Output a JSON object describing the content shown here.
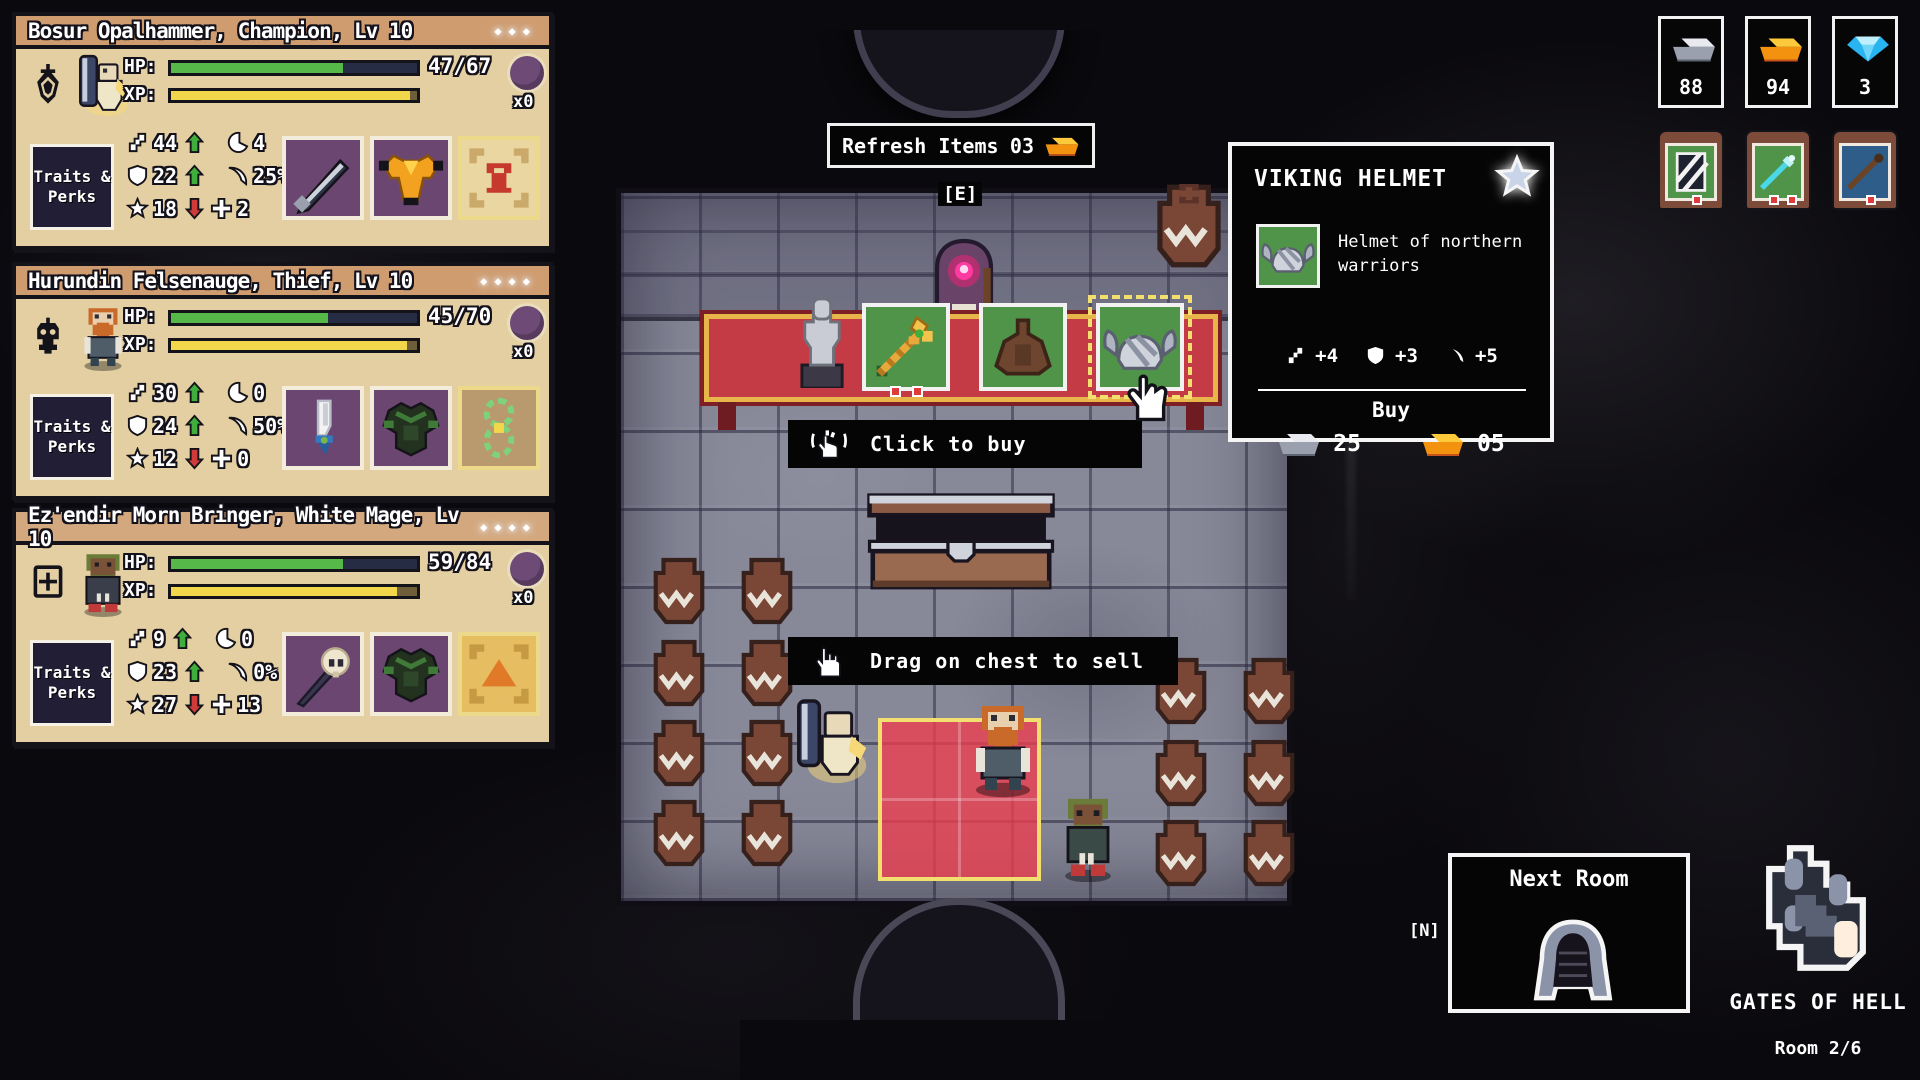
{
  "labels": {
    "hp": "HP:",
    "xp": "XP:",
    "traits_line1": "Traits &",
    "traits_line2": "Perks",
    "refresh": "Refresh Items",
    "refresh_cost": "03",
    "interact_key": "[E]",
    "next_key": "[N]",
    "click_to_buy": "Click to buy",
    "drag_to_sell": "Drag on chest to sell",
    "next_room": "Next Room",
    "location": "GATES OF HELL",
    "room_count": "Room 2/6",
    "sparkles3": "◆◆◆",
    "sparkles4": "◆◆◆◆"
  },
  "resources": {
    "iron": "88",
    "gold": "94",
    "diamond": "3"
  },
  "party": [
    {
      "name": "Bosur Opalhammer, Champion, Lv 10",
      "hp": "47/67",
      "hp_pct": 70,
      "xp_pct": 97,
      "orb_count": "x0",
      "stats": {
        "attack": "44",
        "moves": "4",
        "defense": "22",
        "crit": "25%",
        "dodge": "18",
        "heal": "2"
      },
      "items": [
        "dark-greatsword",
        "golden-armor",
        "red-scroll"
      ]
    },
    {
      "name": "Hurundin Felsenauge, Thief, Lv 10",
      "hp": "45/70",
      "hp_pct": 64,
      "xp_pct": 96,
      "orb_count": "x0",
      "stats": {
        "attack": "30",
        "moves": "0",
        "defense": "24",
        "crit": "50%",
        "dodge": "12",
        "heal": "0"
      },
      "items": [
        "white-dagger",
        "shadow-armor",
        "green-rune"
      ]
    },
    {
      "name": "Ez'endir Morn Bringer, White Mage, Lv 10",
      "hp": "59/84",
      "hp_pct": 70,
      "xp_pct": 92,
      "orb_count": "x0",
      "stats": {
        "attack": "9",
        "moves": "0",
        "defense": "23",
        "crit": "0%",
        "dodge": "27",
        "heal": "13"
      },
      "items": [
        "skull-staff",
        "shadow-armor",
        "mountain-scroll"
      ]
    }
  ],
  "shop": {
    "items": [
      "golden-staff",
      "brown-robe",
      "viking-helmet"
    ]
  },
  "tooltip": {
    "title": "VIKING HELMET",
    "description": "Helmet of northern warriors",
    "attack": "+4",
    "defense": "+3",
    "crit": "+5",
    "buy_label": "Buy",
    "price_iron": "25",
    "price_gold": "05"
  }
}
